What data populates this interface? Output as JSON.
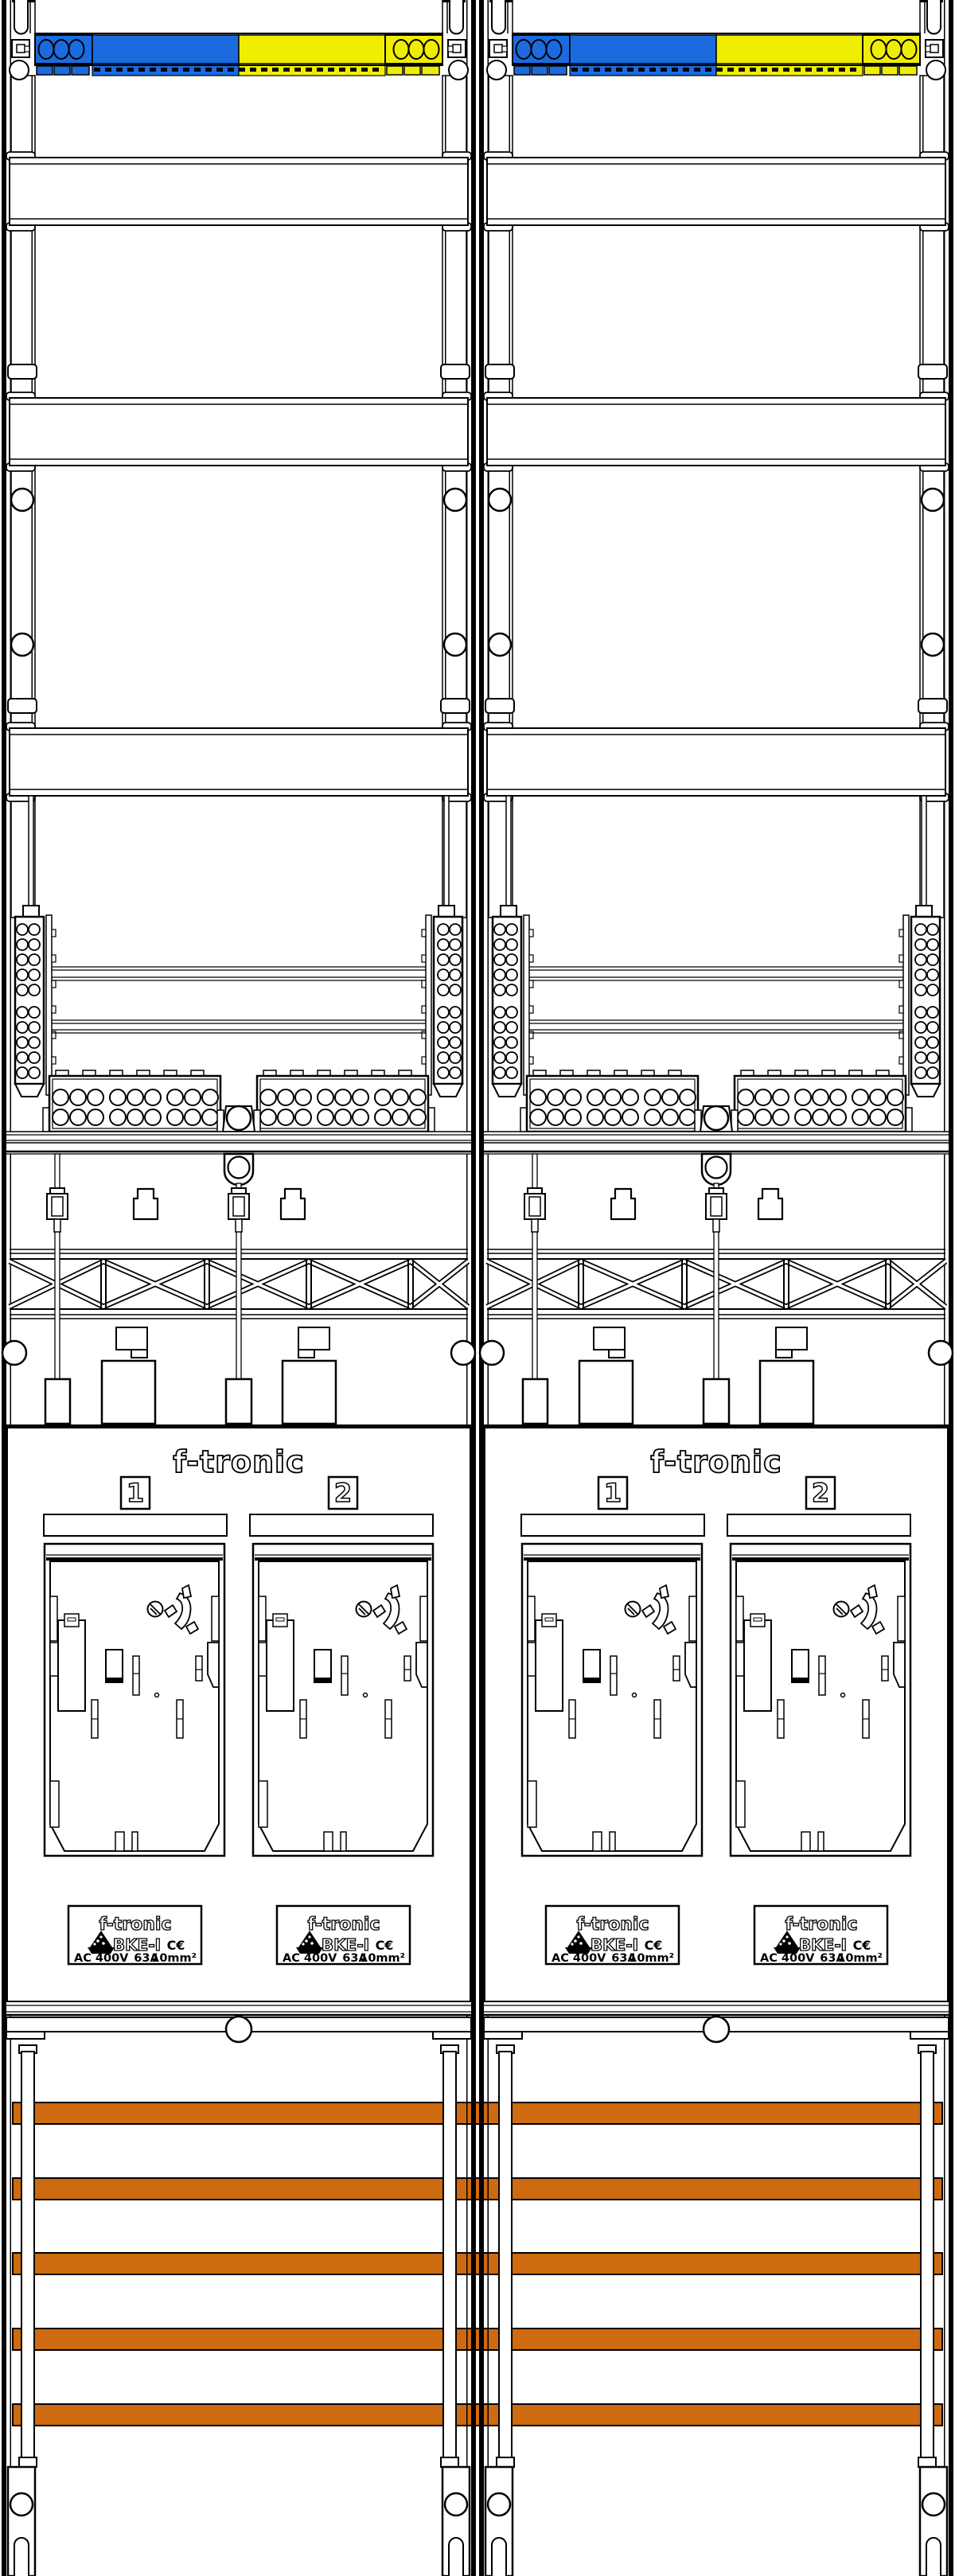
{
  "brand": "f-tronic",
  "columns": 2,
  "meters_per_column": 2,
  "meter_positions": [
    "1",
    "2"
  ],
  "device_label": {
    "brand": "f-tronic",
    "model": "BKE-I",
    "ce_mark": "C€",
    "voltage": "AC 400V",
    "current": "63A",
    "wire_cross_section": "10mm²"
  },
  "busbars": {
    "count": 5
  },
  "colors": {
    "terminal_blue": "#1b6bdf",
    "terminal_yellow": "#f0ee00",
    "busbar_copper": "#ce6a10",
    "line_black": "#000000",
    "background": "#ffffff"
  }
}
